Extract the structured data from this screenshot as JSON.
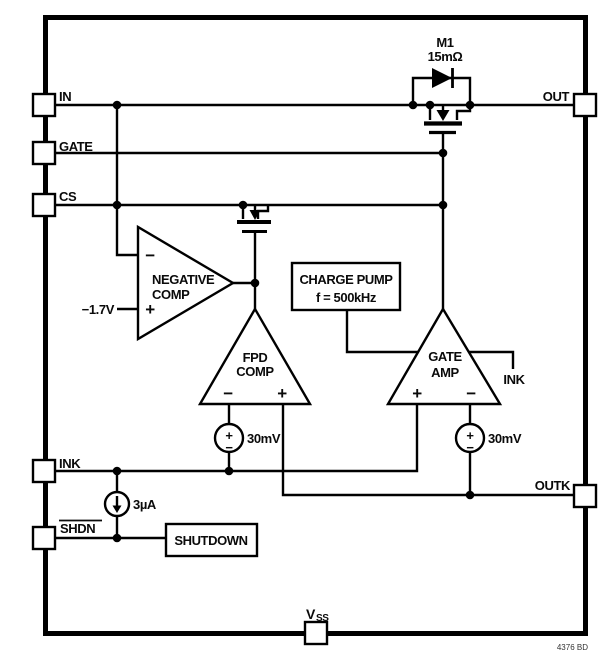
{
  "pins": {
    "in": "IN",
    "gate": "GATE",
    "cs": "CS",
    "ink": "INK",
    "shdn": "SHDN",
    "out": "OUT",
    "outk": "OUTK",
    "vss_main": "V",
    "vss_sub": "SS"
  },
  "pass_fet": {
    "designator": "M1",
    "resistance": "15mΩ"
  },
  "comparators": {
    "negative_comp": {
      "line1": "NEGATIVE",
      "line2": "COMP",
      "minus": "−",
      "plus": "+",
      "ref": "−1.7V"
    },
    "fpd_comp": {
      "line1": "FPD",
      "line2": "COMP",
      "minus": "−",
      "plus": "+"
    },
    "gate_amp": {
      "line1": "GATE",
      "line2": "AMP",
      "plus": "+",
      "minus": "−",
      "net_label": "INK"
    }
  },
  "blocks": {
    "charge_pump": {
      "line1": "CHARGE PUMP",
      "line2": "f = 500kHz"
    },
    "shutdown": {
      "label": "SHUTDOWN"
    }
  },
  "sources": {
    "offset_fpd": {
      "value": "30mV",
      "plus": "+",
      "minus": "−"
    },
    "offset_gate": {
      "value": "30mV",
      "plus": "+",
      "minus": "−"
    },
    "bias": {
      "value": "3µA"
    }
  },
  "footer": {
    "code": "4376 BD"
  },
  "colors": {
    "line": "#000000",
    "background": "#ffffff"
  }
}
